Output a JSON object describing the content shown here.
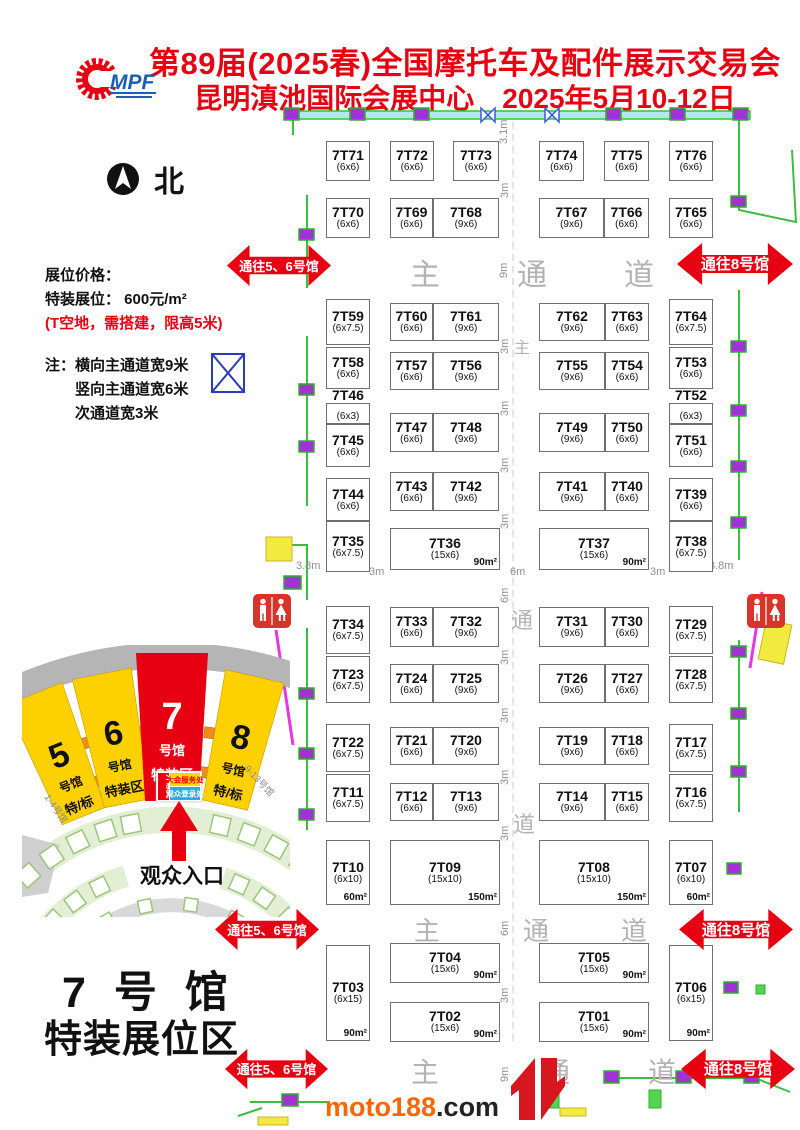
{
  "header": {
    "title_line1": "第89届(2025春)全国摩托车及配件展示交易会",
    "title_line2": "昆明滇池国际会展中心　2025年5月10-12日",
    "logo_mpf": "MPF",
    "accent_color": "#e60012"
  },
  "north_label": "北",
  "info": {
    "price_title": "展位价格：",
    "price_line": "特装展位： 600元/m²",
    "price_note": "(T空地，需搭建，限高5米)",
    "note1": "注：横向主通道宽9米",
    "note2": "竖向主通道宽6米",
    "note3": "次通道宽3米"
  },
  "booths": [
    {
      "n": "7T71",
      "s": "(6x6)",
      "x": 326,
      "y": 141,
      "w": 44,
      "h": 40
    },
    {
      "n": "7T72",
      "s": "(6x6)",
      "x": 390,
      "y": 141,
      "w": 44,
      "h": 40
    },
    {
      "n": "7T73",
      "s": "(6x6)",
      "x": 453,
      "y": 141,
      "w": 46,
      "h": 40
    },
    {
      "n": "7T74",
      "s": "(6x6)",
      "x": 539,
      "y": 141,
      "w": 45,
      "h": 40
    },
    {
      "n": "7T75",
      "s": "(6x6)",
      "x": 604,
      "y": 141,
      "w": 45,
      "h": 40
    },
    {
      "n": "7T76",
      "s": "(6x6)",
      "x": 669,
      "y": 141,
      "w": 44,
      "h": 40
    },
    {
      "n": "7T70",
      "s": "(6x6)",
      "x": 326,
      "y": 198,
      "w": 44,
      "h": 40
    },
    {
      "n": "7T69",
      "s": "(6x6)",
      "x": 390,
      "y": 198,
      "w": 43,
      "h": 40
    },
    {
      "n": "7T68",
      "s": "(9x6)",
      "x": 433,
      "y": 198,
      "w": 66,
      "h": 40
    },
    {
      "n": "7T67",
      "s": "(9x6)",
      "x": 539,
      "y": 198,
      "w": 65,
      "h": 40
    },
    {
      "n": "7T66",
      "s": "(6x6)",
      "x": 604,
      "y": 198,
      "w": 45,
      "h": 40
    },
    {
      "n": "7T65",
      "s": "(6x6)",
      "x": 669,
      "y": 198,
      "w": 44,
      "h": 40
    },
    {
      "n": "7T59",
      "s": "(6x7.5)",
      "x": 326,
      "y": 299,
      "w": 44,
      "h": 46
    },
    {
      "n": "7T60",
      "s": "(6x6)",
      "x": 390,
      "y": 303,
      "w": 43,
      "h": 38
    },
    {
      "n": "7T61",
      "s": "(9x6)",
      "x": 433,
      "y": 303,
      "w": 66,
      "h": 38
    },
    {
      "n": "7T62",
      "s": "(9x6)",
      "x": 539,
      "y": 303,
      "w": 66,
      "h": 38
    },
    {
      "n": "7T63",
      "s": "(6x6)",
      "x": 605,
      "y": 303,
      "w": 44,
      "h": 38
    },
    {
      "n": "7T64",
      "s": "(6x7.5)",
      "x": 669,
      "y": 299,
      "w": 44,
      "h": 46
    },
    {
      "n": "7T58",
      "s": "(6x6)",
      "x": 326,
      "y": 347,
      "w": 44,
      "h": 42
    },
    {
      "n": "7T57",
      "s": "(6x6)",
      "x": 390,
      "y": 352,
      "w": 43,
      "h": 38
    },
    {
      "n": "7T56",
      "s": "(9x6)",
      "x": 433,
      "y": 352,
      "w": 66,
      "h": 38
    },
    {
      "n": "7T55",
      "s": "(9x6)",
      "x": 539,
      "y": 352,
      "w": 66,
      "h": 38
    },
    {
      "n": "7T54",
      "s": "(6x6)",
      "x": 605,
      "y": 352,
      "w": 44,
      "h": 38
    },
    {
      "n": "7T53",
      "s": "(6x6)",
      "x": 669,
      "y": 347,
      "w": 44,
      "h": 42
    },
    {
      "n": "7T46",
      "s": "(6x3)",
      "x": 326,
      "y": 403,
      "w": 44,
      "h": 21,
      "sm": true
    },
    {
      "n": "7T45",
      "s": "(6x6)",
      "x": 326,
      "y": 424,
      "w": 44,
      "h": 43
    },
    {
      "n": "7T47",
      "s": "(6x6)",
      "x": 390,
      "y": 413,
      "w": 43,
      "h": 39
    },
    {
      "n": "7T48",
      "s": "(9x6)",
      "x": 433,
      "y": 413,
      "w": 66,
      "h": 39
    },
    {
      "n": "7T49",
      "s": "(9x6)",
      "x": 539,
      "y": 413,
      "w": 66,
      "h": 39
    },
    {
      "n": "7T50",
      "s": "(6x6)",
      "x": 605,
      "y": 413,
      "w": 44,
      "h": 39
    },
    {
      "n": "7T52",
      "s": "(6x3)",
      "x": 669,
      "y": 403,
      "w": 44,
      "h": 21,
      "sm": true
    },
    {
      "n": "7T51",
      "s": "(6x6)",
      "x": 669,
      "y": 424,
      "w": 44,
      "h": 43
    },
    {
      "n": "7T44",
      "s": "(6x6)",
      "x": 326,
      "y": 478,
      "w": 44,
      "h": 43
    },
    {
      "n": "7T43",
      "s": "(6x6)",
      "x": 390,
      "y": 472,
      "w": 43,
      "h": 39
    },
    {
      "n": "7T42",
      "s": "(9x6)",
      "x": 433,
      "y": 472,
      "w": 66,
      "h": 39
    },
    {
      "n": "7T41",
      "s": "(9x6)",
      "x": 539,
      "y": 472,
      "w": 66,
      "h": 39
    },
    {
      "n": "7T40",
      "s": "(6x6)",
      "x": 605,
      "y": 472,
      "w": 44,
      "h": 39
    },
    {
      "n": "7T39",
      "s": "(6x6)",
      "x": 669,
      "y": 478,
      "w": 44,
      "h": 43
    },
    {
      "n": "7T35",
      "s": "(6x7.5)",
      "x": 326,
      "y": 521,
      "w": 44,
      "h": 51
    },
    {
      "n": "7T36",
      "s": "(15x6)",
      "a": "90m²",
      "x": 390,
      "y": 528,
      "w": 110,
      "h": 42
    },
    {
      "n": "7T37",
      "s": "(15x6)",
      "a": "90m²",
      "x": 539,
      "y": 528,
      "w": 110,
      "h": 42
    },
    {
      "n": "7T38",
      "s": "(6x7.5)",
      "x": 669,
      "y": 521,
      "w": 44,
      "h": 51
    },
    {
      "n": "7T34",
      "s": "(6x7.5)",
      "x": 326,
      "y": 606,
      "w": 44,
      "h": 48
    },
    {
      "n": "7T33",
      "s": "(6x6)",
      "x": 390,
      "y": 607,
      "w": 43,
      "h": 40
    },
    {
      "n": "7T32",
      "s": "(9x6)",
      "x": 433,
      "y": 607,
      "w": 66,
      "h": 40
    },
    {
      "n": "7T31",
      "s": "(9x6)",
      "x": 539,
      "y": 607,
      "w": 66,
      "h": 40
    },
    {
      "n": "7T30",
      "s": "(6x6)",
      "x": 605,
      "y": 607,
      "w": 44,
      "h": 40
    },
    {
      "n": "7T29",
      "s": "(6x7.5)",
      "x": 669,
      "y": 606,
      "w": 44,
      "h": 48
    },
    {
      "n": "7T23",
      "s": "(6x7.5)",
      "x": 326,
      "y": 656,
      "w": 44,
      "h": 47
    },
    {
      "n": "7T24",
      "s": "(6x6)",
      "x": 390,
      "y": 664,
      "w": 43,
      "h": 39
    },
    {
      "n": "7T25",
      "s": "(9x6)",
      "x": 433,
      "y": 664,
      "w": 66,
      "h": 39
    },
    {
      "n": "7T26",
      "s": "(9x6)",
      "x": 539,
      "y": 664,
      "w": 66,
      "h": 39
    },
    {
      "n": "7T27",
      "s": "(6x6)",
      "x": 605,
      "y": 664,
      "w": 44,
      "h": 39
    },
    {
      "n": "7T28",
      "s": "(6x7.5)",
      "x": 669,
      "y": 656,
      "w": 44,
      "h": 47
    },
    {
      "n": "7T22",
      "s": "(6x7.5)",
      "x": 326,
      "y": 724,
      "w": 44,
      "h": 48
    },
    {
      "n": "7T21",
      "s": "(6x6)",
      "x": 390,
      "y": 727,
      "w": 43,
      "h": 38
    },
    {
      "n": "7T20",
      "s": "(9x6)",
      "x": 433,
      "y": 727,
      "w": 66,
      "h": 38
    },
    {
      "n": "7T19",
      "s": "(9x6)",
      "x": 539,
      "y": 727,
      "w": 66,
      "h": 38
    },
    {
      "n": "7T18",
      "s": "(6x6)",
      "x": 605,
      "y": 727,
      "w": 44,
      "h": 38
    },
    {
      "n": "7T17",
      "s": "(6x7.5)",
      "x": 669,
      "y": 724,
      "w": 44,
      "h": 48
    },
    {
      "n": "7T11",
      "s": "(6x7.5)",
      "x": 326,
      "y": 774,
      "w": 44,
      "h": 48
    },
    {
      "n": "7T12",
      "s": "(6x6)",
      "x": 390,
      "y": 783,
      "w": 43,
      "h": 38
    },
    {
      "n": "7T13",
      "s": "(9x6)",
      "x": 433,
      "y": 783,
      "w": 66,
      "h": 38
    },
    {
      "n": "7T14",
      "s": "(9x6)",
      "x": 539,
      "y": 783,
      "w": 66,
      "h": 38
    },
    {
      "n": "7T15",
      "s": "(6x6)",
      "x": 605,
      "y": 783,
      "w": 44,
      "h": 38
    },
    {
      "n": "7T16",
      "s": "(6x7.5)",
      "x": 669,
      "y": 774,
      "w": 44,
      "h": 48
    },
    {
      "n": "7T10",
      "s": "(6x10)",
      "a": "60m²",
      "x": 326,
      "y": 840,
      "w": 44,
      "h": 65
    },
    {
      "n": "7T09",
      "s": "(15x10)",
      "a": "150m²",
      "x": 390,
      "y": 840,
      "w": 110,
      "h": 65
    },
    {
      "n": "7T08",
      "s": "(15x10)",
      "a": "150m²",
      "x": 539,
      "y": 840,
      "w": 110,
      "h": 65
    },
    {
      "n": "7T07",
      "s": "(6x10)",
      "a": "60m²",
      "x": 669,
      "y": 840,
      "w": 44,
      "h": 65
    },
    {
      "n": "7T03",
      "s": "(6x15)",
      "a": "90m²",
      "x": 326,
      "y": 945,
      "w": 44,
      "h": 96
    },
    {
      "n": "7T04",
      "s": "(15x6)",
      "a": "90m²",
      "x": 390,
      "y": 943,
      "w": 110,
      "h": 40
    },
    {
      "n": "7T05",
      "s": "(15x6)",
      "a": "90m²",
      "x": 539,
      "y": 943,
      "w": 110,
      "h": 40
    },
    {
      "n": "7T06",
      "s": "(6x15)",
      "a": "90m²",
      "x": 669,
      "y": 945,
      "w": 44,
      "h": 96
    },
    {
      "n": "7T02",
      "s": "(15x6)",
      "a": "90m²",
      "x": 390,
      "y": 1002,
      "w": 110,
      "h": 40
    },
    {
      "n": "7T01",
      "s": "(15x6)",
      "a": "90m²",
      "x": 539,
      "y": 1002,
      "w": 110,
      "h": 40
    }
  ],
  "corridor_labels": [
    {
      "t": "主",
      "x": 410,
      "y": 250,
      "s": 30
    },
    {
      "t": "通",
      "x": 517,
      "y": 250,
      "s": 30
    },
    {
      "t": "道",
      "x": 624,
      "y": 250,
      "s": 30
    },
    {
      "t": "主",
      "x": 514,
      "y": 334,
      "s": 16
    },
    {
      "t": "通",
      "x": 511,
      "y": 603,
      "s": 22
    },
    {
      "t": "道",
      "x": 513,
      "y": 807,
      "s": 22
    },
    {
      "t": "主",
      "x": 414,
      "y": 911,
      "s": 26
    },
    {
      "t": "通",
      "x": 523,
      "y": 911,
      "s": 26
    },
    {
      "t": "道",
      "x": 621,
      "y": 911,
      "s": 26
    },
    {
      "t": "主",
      "x": 411,
      "y": 1051,
      "s": 28
    },
    {
      "t": "通",
      "x": 542,
      "y": 1051,
      "s": 28
    },
    {
      "t": "道",
      "x": 648,
      "y": 1051,
      "s": 28
    }
  ],
  "dims": [
    {
      "t": "3.1m",
      "x": 498,
      "y": 130,
      "v": 1
    },
    {
      "t": "3m",
      "x": 499,
      "y": 184,
      "v": 1
    },
    {
      "t": "9m",
      "x": 498,
      "y": 264,
      "v": 1
    },
    {
      "t": "3m",
      "x": 499,
      "y": 340,
      "v": 1
    },
    {
      "t": "3m",
      "x": 499,
      "y": 402,
      "v": 1
    },
    {
      "t": "3m",
      "x": 499,
      "y": 459,
      "v": 1
    },
    {
      "t": "3m",
      "x": 499,
      "y": 515,
      "v": 1
    },
    {
      "t": "3.8m",
      "x": 296,
      "y": 566,
      "v": 0
    },
    {
      "t": "3m",
      "x": 369,
      "y": 572,
      "v": 0
    },
    {
      "t": "6m",
      "x": 510,
      "y": 572,
      "v": 0
    },
    {
      "t": "3m",
      "x": 650,
      "y": 572,
      "v": 0
    },
    {
      "t": "3.8m",
      "x": 709,
      "y": 566,
      "v": 0
    },
    {
      "t": "6m",
      "x": 499,
      "y": 589,
      "v": 1
    },
    {
      "t": "3m",
      "x": 499,
      "y": 651,
      "v": 1
    },
    {
      "t": "3m",
      "x": 499,
      "y": 709,
      "v": 1
    },
    {
      "t": "3m",
      "x": 499,
      "y": 771,
      "v": 1
    },
    {
      "t": "3m",
      "x": 499,
      "y": 827,
      "v": 1
    },
    {
      "t": "6m",
      "x": 499,
      "y": 922,
      "v": 1
    },
    {
      "t": "3m",
      "x": 499,
      "y": 989,
      "v": 1
    },
    {
      "t": "9m",
      "x": 499,
      "y": 1068,
      "v": 1
    }
  ],
  "nav_arrows": [
    {
      "label": "通往5、6号馆",
      "x": 227,
      "y": 243,
      "w": 104,
      "h": 45,
      "fs": 13
    },
    {
      "label": "通往8号馆",
      "x": 677,
      "y": 241,
      "w": 116,
      "h": 46,
      "fs": 15
    },
    {
      "label": "通往5、6号馆",
      "x": 215,
      "y": 907,
      "w": 104,
      "h": 45,
      "fs": 13
    },
    {
      "label": "通往8号馆",
      "x": 679,
      "y": 907,
      "w": 114,
      "h": 45,
      "fs": 15
    },
    {
      "label": "通往5、6号馆",
      "x": 225,
      "y": 1047,
      "w": 103,
      "h": 44,
      "fs": 13
    },
    {
      "label": "通往8号馆",
      "x": 681,
      "y": 1047,
      "w": 114,
      "h": 44,
      "fs": 15
    }
  ],
  "inset": {
    "halls": [
      {
        "num": "5",
        "hall": "号馆",
        "tag": "特/标"
      },
      {
        "num": "6",
        "hall": "号馆",
        "tag": "特装区"
      },
      {
        "num": "7",
        "hall": "号馆",
        "tag": "特装区"
      },
      {
        "num": "8",
        "hall": "号馆",
        "tag": "特/标"
      }
    ],
    "left_wing": "1-4号馆",
    "right_wing": "9-13号馆",
    "badges": {
      "ceremony": "开幕式",
      "service": "大会服务处",
      "registration": "观众登录处"
    },
    "entrance": "观众入口"
  },
  "footer": {
    "hall_title": "7 号 馆",
    "hall_subtitle": "特装展位区"
  },
  "watermark": {
    "orange": "moto188",
    "dark": ".com"
  }
}
